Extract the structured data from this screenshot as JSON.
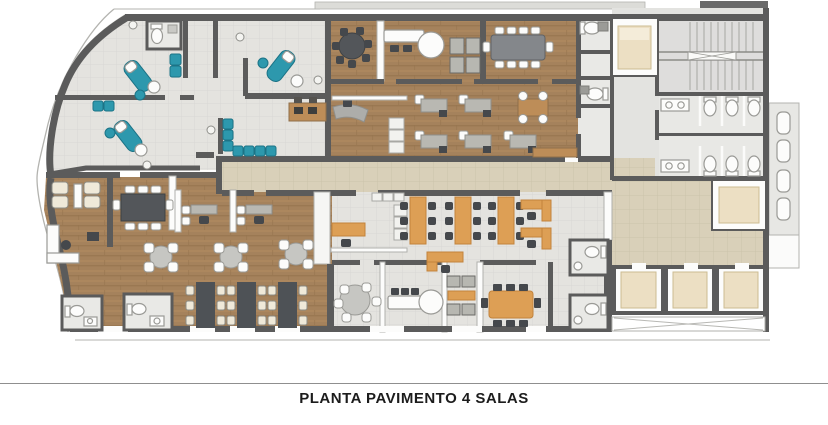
{
  "caption": {
    "text": "PLANTA PAVIMENTO 4 SALAS"
  },
  "palette": {
    "wall": "#5b5b5b",
    "outline": "#b3b3af",
    "white": "#fcfcfb",
    "floor_tile": "#e4e3df",
    "room_tile": "#e9e9e6",
    "floor_wood": "#a5825c",
    "wood_grain": "#96744e",
    "wood_light": "#b28a60",
    "wood_accent": "#bd8d58",
    "floor_corridor": "#d9d0b9",
    "corridor_grid": "#c8bfa7",
    "teal": "#2d98ad",
    "teal_dark": "#1c7386",
    "cream": "#efe9d9",
    "gray_desk": "#b9b8b2",
    "dark_furniture": "#4b4f53",
    "orange": "#dd9f55",
    "orange_dark": "#c2833c",
    "cab": "#ecdfc3",
    "divider": "#8f8f8f",
    "caption_text": "#1c1c1c"
  }
}
